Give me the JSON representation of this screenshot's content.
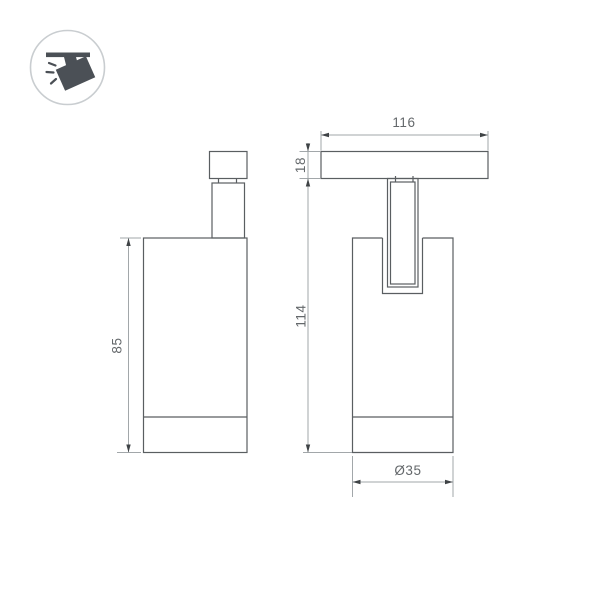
{
  "logo": {
    "icon": "track-spotlight-icon",
    "circle_border_color": "#c9cdd0",
    "icon_color": "#4b5056"
  },
  "drawing": {
    "object_line_color": "#5a5e61",
    "dimension_line_color": "#a2a7aa",
    "arrow_color": "#3f4346",
    "label_color": "#64686b",
    "dimensions": {
      "track_base_width": {
        "label": "116"
      },
      "track_base_height": {
        "label": "18"
      },
      "overall_height": {
        "label": "114"
      },
      "body_height": {
        "label": "85"
      },
      "body_diameter": {
        "label": "Ø35"
      }
    }
  }
}
